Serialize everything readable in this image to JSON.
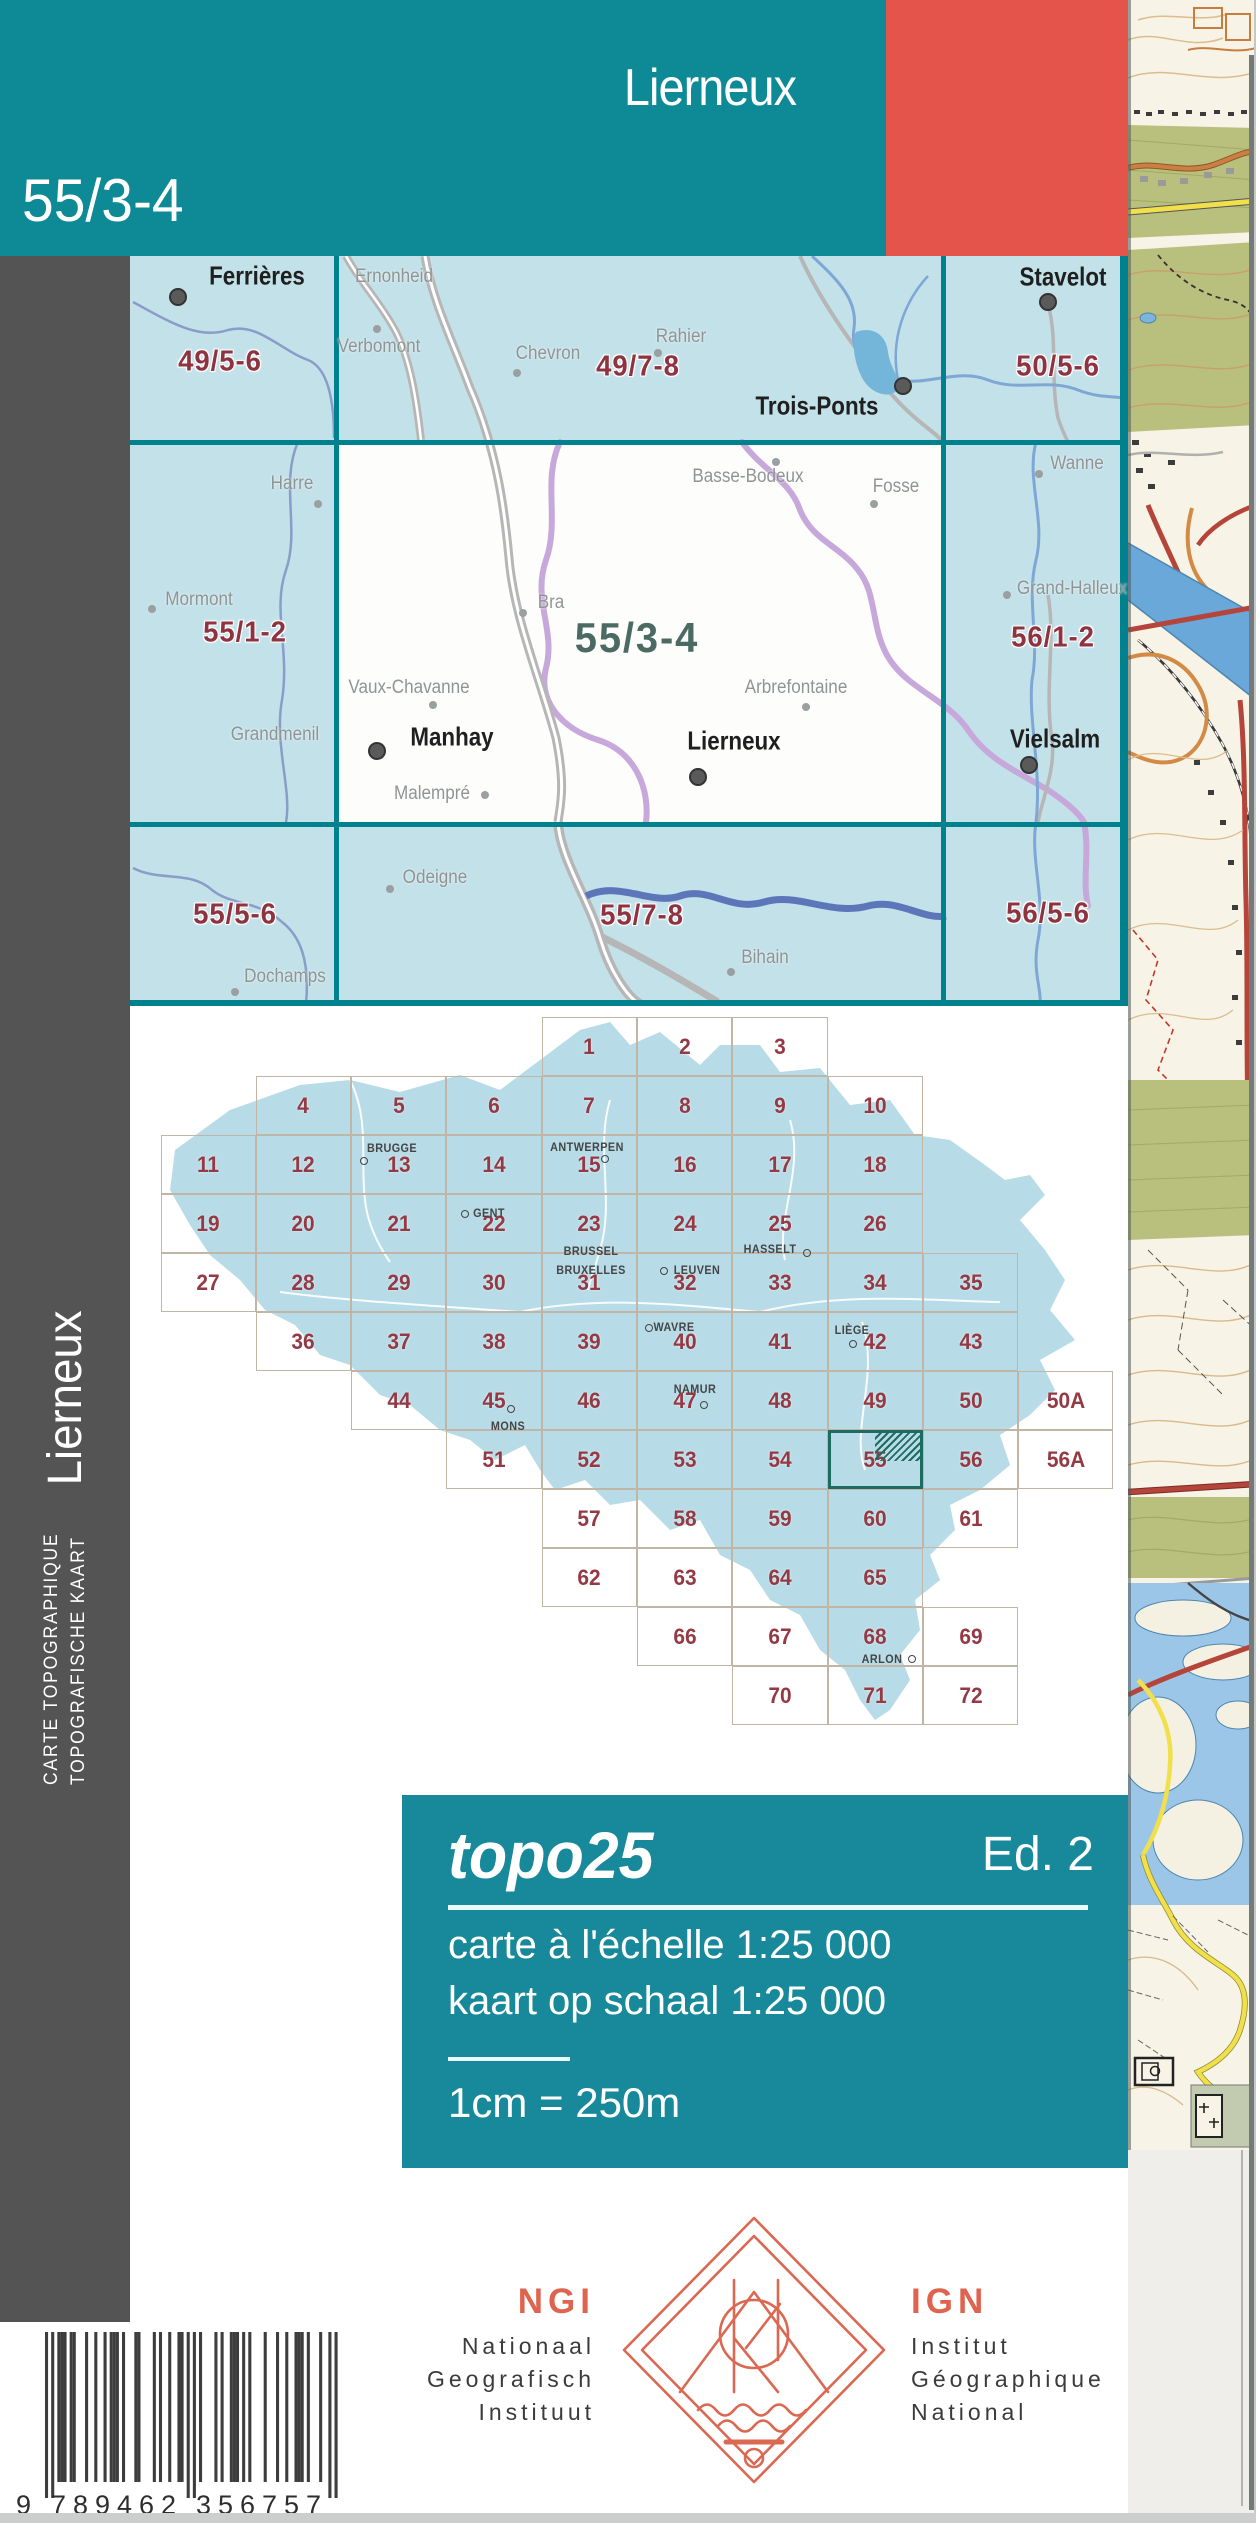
{
  "header": {
    "title": "Lierneux",
    "sheet_number": "55/3-4"
  },
  "spine": {
    "title": "Lierneux",
    "line1": "CARTE TOPOGRAPHIQUE",
    "line2": "TOPOGRAFISCHE KAART"
  },
  "index_map": {
    "current_sheet": {
      "code": "55/3-4",
      "x": 637,
      "y": 638
    },
    "sheet_labels": [
      {
        "code": "49/5-6",
        "x": 220,
        "y": 362
      },
      {
        "code": "49/7-8",
        "x": 638,
        "y": 367
      },
      {
        "code": "50/5-6",
        "x": 1058,
        "y": 367
      },
      {
        "code": "55/1-2",
        "x": 245,
        "y": 633
      },
      {
        "code": "56/1-2",
        "x": 1053,
        "y": 638
      },
      {
        "code": "55/5-6",
        "x": 235,
        "y": 915
      },
      {
        "code": "55/7-8",
        "x": 642,
        "y": 916
      },
      {
        "code": "56/5-6",
        "x": 1048,
        "y": 914
      }
    ],
    "towns": [
      {
        "name": "Ferrières",
        "x": 257,
        "y": 276,
        "dot": {
          "x": 178,
          "y": 297
        }
      },
      {
        "name": "Stavelot",
        "x": 1063,
        "y": 277,
        "dot": {
          "x": 1048,
          "y": 302
        }
      },
      {
        "name": "Trois-Ponts",
        "x": 817,
        "y": 406,
        "dot": {
          "x": 903,
          "y": 386
        }
      },
      {
        "name": "Manhay",
        "x": 452,
        "y": 737,
        "dot": {
          "x": 377,
          "y": 751
        }
      },
      {
        "name": "Lierneux",
        "x": 734,
        "y": 741,
        "dot": {
          "x": 698,
          "y": 777
        }
      },
      {
        "name": "Vielsalm",
        "x": 1055,
        "y": 739,
        "dot": {
          "x": 1029,
          "y": 765
        }
      }
    ],
    "villages": [
      {
        "name": "Ernonheid",
        "x": 394,
        "y": 277
      },
      {
        "name": "Verbomont",
        "x": 379,
        "y": 347,
        "dot": {
          "x": 377,
          "y": 329
        }
      },
      {
        "name": "Chevron",
        "x": 548,
        "y": 354,
        "dot": {
          "x": 517,
          "y": 373
        }
      },
      {
        "name": "Rahier",
        "x": 681,
        "y": 337,
        "dot": {
          "x": 658,
          "y": 353
        }
      },
      {
        "name": "Harre",
        "x": 292,
        "y": 484,
        "dot": {
          "x": 318,
          "y": 504
        }
      },
      {
        "name": "Mormont",
        "x": 199,
        "y": 600,
        "dot": {
          "x": 152,
          "y": 609
        }
      },
      {
        "name": "Grandmenil",
        "x": 275,
        "y": 735
      },
      {
        "name": "Basse-Bodeux",
        "x": 748,
        "y": 477,
        "dot": {
          "x": 776,
          "y": 462
        }
      },
      {
        "name": "Fosse",
        "x": 896,
        "y": 487,
        "dot": {
          "x": 874,
          "y": 504
        }
      },
      {
        "name": "Wanne",
        "x": 1077,
        "y": 464,
        "dot": {
          "x": 1039,
          "y": 474
        }
      },
      {
        "name": "Bra",
        "x": 551,
        "y": 603,
        "dot": {
          "x": 523,
          "y": 613
        }
      },
      {
        "name": "Grand-Halleux",
        "x": 1072,
        "y": 589,
        "dot": {
          "x": 1007,
          "y": 595
        }
      },
      {
        "name": "Vaux-Chavanne",
        "x": 409,
        "y": 688,
        "dot": {
          "x": 433,
          "y": 705
        }
      },
      {
        "name": "Arbrefontaine",
        "x": 796,
        "y": 688,
        "dot": {
          "x": 806,
          "y": 707
        }
      },
      {
        "name": "Malempré",
        "x": 432,
        "y": 794,
        "dot": {
          "x": 485,
          "y": 795
        }
      },
      {
        "name": "Odeigne",
        "x": 435,
        "y": 878,
        "dot": {
          "x": 390,
          "y": 889
        }
      },
      {
        "name": "Dochamps",
        "x": 285,
        "y": 977,
        "dot": {
          "x": 235,
          "y": 992
        }
      },
      {
        "name": "Bihain",
        "x": 765,
        "y": 958,
        "dot": {
          "x": 731,
          "y": 972
        }
      }
    ]
  },
  "belgium_grid": {
    "highlighted_cell": "55",
    "cells": [
      {
        "t": "1",
        "c": 4,
        "r": 0
      },
      {
        "t": "2",
        "c": 5,
        "r": 0
      },
      {
        "t": "3",
        "c": 6,
        "r": 0
      },
      {
        "t": "4",
        "c": 1,
        "r": 1
      },
      {
        "t": "5",
        "c": 2,
        "r": 1
      },
      {
        "t": "6",
        "c": 3,
        "r": 1
      },
      {
        "t": "7",
        "c": 4,
        "r": 1
      },
      {
        "t": "8",
        "c": 5,
        "r": 1
      },
      {
        "t": "9",
        "c": 6,
        "r": 1
      },
      {
        "t": "10",
        "c": 7,
        "r": 1
      },
      {
        "t": "11",
        "c": 0,
        "r": 2
      },
      {
        "t": "12",
        "c": 1,
        "r": 2
      },
      {
        "t": "13",
        "c": 2,
        "r": 2
      },
      {
        "t": "14",
        "c": 3,
        "r": 2
      },
      {
        "t": "15",
        "c": 4,
        "r": 2
      },
      {
        "t": "16",
        "c": 5,
        "r": 2
      },
      {
        "t": "17",
        "c": 6,
        "r": 2
      },
      {
        "t": "18",
        "c": 7,
        "r": 2
      },
      {
        "t": "19",
        "c": 0,
        "r": 3
      },
      {
        "t": "20",
        "c": 1,
        "r": 3
      },
      {
        "t": "21",
        "c": 2,
        "r": 3
      },
      {
        "t": "22",
        "c": 3,
        "r": 3
      },
      {
        "t": "23",
        "c": 4,
        "r": 3
      },
      {
        "t": "24",
        "c": 5,
        "r": 3
      },
      {
        "t": "25",
        "c": 6,
        "r": 3
      },
      {
        "t": "26",
        "c": 7,
        "r": 3
      },
      {
        "t": "27",
        "c": 0,
        "r": 4
      },
      {
        "t": "28",
        "c": 1,
        "r": 4
      },
      {
        "t": "29",
        "c": 2,
        "r": 4
      },
      {
        "t": "30",
        "c": 3,
        "r": 4
      },
      {
        "t": "31",
        "c": 4,
        "r": 4
      },
      {
        "t": "32",
        "c": 5,
        "r": 4
      },
      {
        "t": "33",
        "c": 6,
        "r": 4
      },
      {
        "t": "34",
        "c": 7,
        "r": 4
      },
      {
        "t": "35",
        "c": 8,
        "r": 4
      },
      {
        "t": "36",
        "c": 1,
        "r": 5
      },
      {
        "t": "37",
        "c": 2,
        "r": 5
      },
      {
        "t": "38",
        "c": 3,
        "r": 5
      },
      {
        "t": "39",
        "c": 4,
        "r": 5
      },
      {
        "t": "40",
        "c": 5,
        "r": 5
      },
      {
        "t": "41",
        "c": 6,
        "r": 5
      },
      {
        "t": "42",
        "c": 7,
        "r": 5
      },
      {
        "t": "43",
        "c": 8,
        "r": 5
      },
      {
        "t": "44",
        "c": 2,
        "r": 6
      },
      {
        "t": "45",
        "c": 3,
        "r": 6
      },
      {
        "t": "46",
        "c": 4,
        "r": 6
      },
      {
        "t": "47",
        "c": 5,
        "r": 6
      },
      {
        "t": "48",
        "c": 6,
        "r": 6
      },
      {
        "t": "49",
        "c": 7,
        "r": 6
      },
      {
        "t": "50",
        "c": 8,
        "r": 6
      },
      {
        "t": "50A",
        "c": 9,
        "r": 6
      },
      {
        "t": "51",
        "c": 3,
        "r": 7
      },
      {
        "t": "52",
        "c": 4,
        "r": 7
      },
      {
        "t": "53",
        "c": 5,
        "r": 7
      },
      {
        "t": "54",
        "c": 6,
        "r": 7
      },
      {
        "t": "55",
        "c": 7,
        "r": 7
      },
      {
        "t": "56",
        "c": 8,
        "r": 7
      },
      {
        "t": "56A",
        "c": 9,
        "r": 7
      },
      {
        "t": "57",
        "c": 4,
        "r": 8
      },
      {
        "t": "58",
        "c": 5,
        "r": 8
      },
      {
        "t": "59",
        "c": 6,
        "r": 8
      },
      {
        "t": "60",
        "c": 7,
        "r": 8
      },
      {
        "t": "61",
        "c": 8,
        "r": 8
      },
      {
        "t": "62",
        "c": 4,
        "r": 9
      },
      {
        "t": "63",
        "c": 5,
        "r": 9
      },
      {
        "t": "64",
        "c": 6,
        "r": 9
      },
      {
        "t": "65",
        "c": 7,
        "r": 9
      },
      {
        "t": "66",
        "c": 5,
        "r": 10
      },
      {
        "t": "67",
        "c": 6,
        "r": 10
      },
      {
        "t": "68",
        "c": 7,
        "r": 10
      },
      {
        "t": "69",
        "c": 8,
        "r": 10
      },
      {
        "t": "70",
        "c": 6,
        "r": 11
      },
      {
        "t": "71",
        "c": 7,
        "r": 11
      },
      {
        "t": "72",
        "c": 8,
        "r": 11
      }
    ],
    "cities": [
      {
        "name": "BRUGGE",
        "x": 392,
        "y": 1148,
        "dot": {
          "x": 364,
          "y": 1161
        }
      },
      {
        "name": "ANTWERPEN",
        "x": 587,
        "y": 1147,
        "dot": {
          "x": 605,
          "y": 1159
        }
      },
      {
        "name": "GENT",
        "x": 489,
        "y": 1213,
        "dot": {
          "x": 465,
          "y": 1214
        }
      },
      {
        "name": "BRUSSEL",
        "x": 591,
        "y": 1251
      },
      {
        "name": "BRUXELLES",
        "x": 591,
        "y": 1270
      },
      {
        "name": "LEUVEN",
        "x": 697,
        "y": 1270,
        "dot": {
          "x": 664,
          "y": 1271
        }
      },
      {
        "name": "HASSELT",
        "x": 770,
        "y": 1249,
        "dot": {
          "x": 807,
          "y": 1253
        }
      },
      {
        "name": "WAVRE",
        "x": 674,
        "y": 1327,
        "dot": {
          "x": 649,
          "y": 1328
        }
      },
      {
        "name": "LIÈGE",
        "x": 852,
        "y": 1330,
        "dot": {
          "x": 853,
          "y": 1344
        }
      },
      {
        "name": "NAMUR",
        "x": 695,
        "y": 1389,
        "dot": {
          "x": 704,
          "y": 1405
        }
      },
      {
        "name": "MONS",
        "x": 508,
        "y": 1426,
        "dot": {
          "x": 511,
          "y": 1409
        }
      },
      {
        "name": "ARLON",
        "x": 882,
        "y": 1659,
        "dot": {
          "x": 912,
          "y": 1659
        }
      }
    ]
  },
  "info_block": {
    "series": "topo25",
    "edition": "Ed. 2",
    "scale_fr": "carte à l'échelle 1:25 000",
    "scale_nl": "kaart op schaal 1:25 000",
    "equivalence": "1cm = 250m"
  },
  "publisher": {
    "left": {
      "abbr": "NGI",
      "line1": "Nationaal",
      "line2": "Geografisch",
      "line3": "Instituut"
    },
    "right": {
      "abbr": "IGN",
      "line1": "Institut",
      "line2": "Géographique",
      "line3": "National"
    }
  },
  "barcode": {
    "ean": "9789462356757",
    "first_digit": "9",
    "left_group": "789462",
    "right_group": "356757"
  },
  "colors": {
    "cover_teal": "#0e8a96",
    "cover_red": "#e4544b",
    "info_teal": "#17899a",
    "sidebar_gray": "#535453",
    "index_bg": "#c3e1e9",
    "index_grid": "#00828e",
    "sheet_code_red": "#8e3340",
    "current_sheet_teal": "#4b6a63",
    "belgium_fill": "#b7dbe7",
    "grid_number_red": "#943a44",
    "ngi_red": "#df644f",
    "highlight_teal": "#1e6b60"
  }
}
